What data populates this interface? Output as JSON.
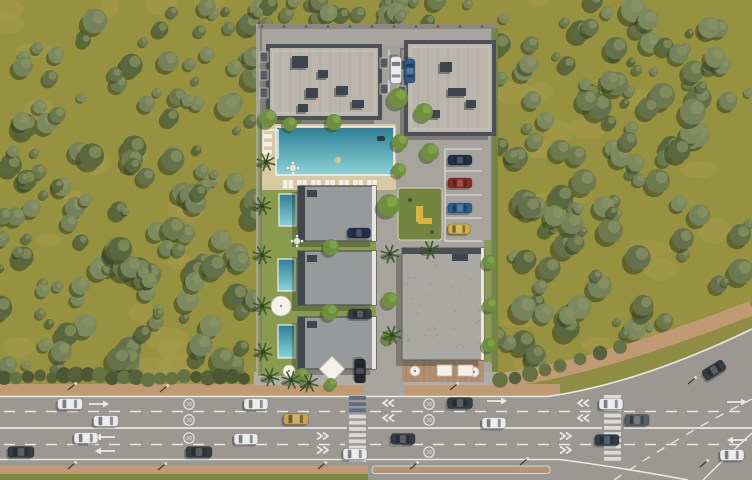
{
  "scene_label": "aerial-render-residential-complex",
  "road": {
    "speed_symbol": "30"
  },
  "palette": {
    "forest_ground": "#97923f",
    "forest_ground_light": "#a89c4e",
    "tree_shadow": "#35401f",
    "tree_highlight": "#8b9464",
    "tree_bodies": [
      "#6d7a4e",
      "#75825a",
      "#64714a",
      "#7c8a5e",
      "#59683e"
    ],
    "hedge": [
      "#55613a",
      "#647244",
      "#4c5833"
    ],
    "property_paver": "#a7a49d",
    "property_paver_light": "#b0ada6",
    "lawn": "#8a9a4e",
    "lawn_dark": "#73853f",
    "roof_light": "#bab6ac",
    "roof_trim": "#4d5157",
    "roof_box": "#3e4550",
    "villa_roof": "#97999b",
    "villa_roof_dark": "#40464e",
    "big_roof": "#a9a8a3",
    "deck_wood": "#b09070",
    "pool_deep": "#2c7f97",
    "pool_shallow": "#8ed2d6",
    "pool_rim": "#f0efe8",
    "pool_deck": "#d9c9a3",
    "road_gray": "#9b9793",
    "line_white": "#e9e9e6",
    "tan": "#c09a73",
    "grass": "#7a8a3e",
    "median_gravel": "#b29676",
    "crosswalk_blue": "#5a6a84",
    "wall": "#8a8a82",
    "play_yellow": "#d9b33c",
    "car_colors": {
      "white": "#e9eae9",
      "dark": "#363c43",
      "gray": "#585e64",
      "gold": "#c9a153",
      "red": "#8e2823",
      "blue": "#2b5e91",
      "navy": "#232f49",
      "yellow": "#d2af3e",
      "black": "#24272b"
    }
  },
  "scene": {
    "forest": {
      "left_rect": {
        "x": 0,
        "y": 0,
        "w": 258,
        "h": 384
      },
      "top_rect": {
        "x": 258,
        "y": 0,
        "w": 238,
        "h": 28
      },
      "right_poly": "M494,0 H752 V300 C700,316 640,346 560,366 C540,370 515,372 494,372 Z",
      "right_edge_samples": [
        [
          494,
          370
        ],
        [
          560,
          364
        ],
        [
          620,
          348
        ],
        [
          680,
          328
        ],
        [
          752,
          298
        ]
      ],
      "tree_counts": {
        "left": 155,
        "right": 130,
        "top": 26
      },
      "patch_counts": {
        "left": 26,
        "right": 20
      }
    },
    "roadside": {
      "tan_north": {
        "x": 0,
        "y": 384,
        "w": 560,
        "h": 12
      },
      "tan_curve": "M494,381 C560,374 640,351 752,308",
      "sidewalk_front": {
        "x": 254,
        "y": 372,
        "w": 246,
        "h": 13
      },
      "tan_south": {
        "x": 0,
        "y": 466,
        "w": 368,
        "h": 8
      },
      "grass_south": {
        "x": 0,
        "y": 474,
        "w": 368,
        "h": 6
      },
      "hedge_curve": [
        [
          500,
          380
        ],
        [
          515,
          378
        ],
        [
          530,
          374
        ],
        [
          545,
          370
        ],
        [
          560,
          366
        ],
        [
          580,
          359
        ],
        [
          600,
          353
        ],
        [
          620,
          347
        ]
      ]
    },
    "roadway": {
      "main_poly": "M0,397 H548 C620,386 690,358 752,328 V480 H0 Z",
      "north_curb": "M0,396.5 H548 C620,386 690,359 752,329",
      "south_curb": "M0,459.5 H560",
      "branch_west": "M560,459.5 C610,466 650,473 688,480",
      "branch_east": "M703,480 C722,461 737,447 752,433",
      "branch_dash": "M614,480 C662,448 704,423 752,399",
      "dashes": [
        {
          "y": 411.5,
          "segs": [
            [
              4,
              345
            ],
            [
              370,
              600
            ],
            [
              624,
              748
            ]
          ]
        },
        {
          "y": 444.5,
          "segs": [
            [
              4,
              345
            ],
            [
              370,
              600
            ],
            [
              624,
              748
            ]
          ]
        }
      ],
      "solids": [
        {
          "y": 428,
          "segs": [
            [
              0,
              347
            ],
            [
              368,
              602
            ],
            [
              624,
              752
            ]
          ],
          "w": 1.8
        }
      ],
      "median": {
        "x": 372,
        "y": 466,
        "w": 178,
        "h": 7.5
      },
      "entrance_apron": {
        "x": 363,
        "y": 372,
        "w": 42,
        "h": 25
      },
      "crosswalks": [
        {
          "x": 349,
          "w": 17,
          "y0": 396,
          "y1": 458,
          "blue_top": 3
        },
        {
          "x": 604,
          "w": 17,
          "y0": 395,
          "y1": 458,
          "blue_top": 0
        }
      ],
      "arrows": [
        {
          "x": 102,
          "y": 404,
          "dir": "left"
        },
        {
          "x": 740,
          "y": 402,
          "dir": "left"
        },
        {
          "x": 102,
          "y": 437,
          "dir": "right"
        },
        {
          "x": 102,
          "y": 451,
          "dir": "right"
        },
        {
          "x": 500,
          "y": 401,
          "dir": "left"
        },
        {
          "x": 734,
          "y": 440,
          "dir": "right"
        }
      ],
      "chevrons": [
        {
          "x": 383,
          "y": 403,
          "dir": "left"
        },
        {
          "x": 383,
          "y": 418,
          "dir": "left"
        },
        {
          "x": 328,
          "y": 436,
          "dir": "right"
        },
        {
          "x": 328,
          "y": 450,
          "dir": "right"
        },
        {
          "x": 578,
          "y": 403,
          "dir": "left"
        },
        {
          "x": 578,
          "y": 418,
          "dir": "left"
        },
        {
          "x": 571,
          "y": 436,
          "dir": "right"
        },
        {
          "x": 571,
          "y": 450,
          "dir": "right"
        }
      ],
      "speed_circles": [
        {
          "x": 189,
          "y": 404
        },
        {
          "x": 189,
          "y": 420
        },
        {
          "x": 189,
          "y": 438
        },
        {
          "x": 429,
          "y": 404
        },
        {
          "x": 429,
          "y": 420
        },
        {
          "x": 429,
          "y": 452
        }
      ],
      "lamps": [
        [
          68,
          390
        ],
        [
          160,
          392
        ],
        [
          300,
          391
        ],
        [
          450,
          390
        ],
        [
          68,
          469
        ],
        [
          158,
          470
        ],
        [
          318,
          469
        ],
        [
          410,
          469
        ],
        [
          520,
          465
        ],
        [
          688,
          384
        ],
        [
          700,
          467
        ]
      ]
    },
    "property": {
      "base": {
        "x": 256,
        "y": 24,
        "w": 240,
        "h": 348
      },
      "wall_top": {
        "x": 258,
        "y": 24,
        "w": 238,
        "h": 5
      },
      "right_green": {
        "x": 492,
        "y": 28,
        "w": 6,
        "h": 344
      },
      "lawns": [
        {
          "x": 258,
          "y": 120,
          "w": 44,
          "h": 256
        },
        {
          "x": 302,
          "y": 241,
          "w": 74,
          "h": 10
        },
        {
          "x": 302,
          "y": 305,
          "w": 74,
          "h": 12
        },
        {
          "x": 484,
          "y": 240,
          "w": 8,
          "h": 122
        }
      ],
      "terrace_deck": {
        "x": 402,
        "y": 360,
        "w": 82,
        "h": 22
      },
      "top_parking": {
        "x": 382,
        "y": 46,
        "w": 38,
        "h": 50,
        "stall_x": [
          389,
          403,
          417
        ]
      },
      "stall_lines": {
        "x0": 445,
        "x1": 482,
        "ys": [
          149,
          171,
          195,
          218,
          241
        ]
      },
      "playground": {
        "x": 398,
        "y": 188,
        "w": 44,
        "h": 52
      }
    },
    "buildings": [
      {
        "name": "apartment-block-a",
        "x": 268,
        "y": 46,
        "w": 112,
        "h": 72,
        "style": "apartment",
        "boxes": [
          [
            292,
            56,
            16,
            12
          ],
          [
            306,
            88,
            12,
            10
          ],
          [
            336,
            86,
            12,
            9
          ],
          [
            352,
            100,
            12,
            8
          ],
          [
            298,
            104,
            10,
            8
          ],
          [
            318,
            70,
            10,
            8
          ]
        ],
        "balconies": [
          [
            260,
            52,
            8,
            10
          ],
          [
            260,
            70,
            8,
            10
          ],
          [
            260,
            88,
            8,
            10
          ],
          [
            380,
            58,
            8,
            10
          ],
          [
            380,
            84,
            8,
            10
          ]
        ]
      },
      {
        "name": "apartment-block-b",
        "x": 406,
        "y": 42,
        "w": 88,
        "h": 92,
        "style": "apartment",
        "boxes": [
          [
            440,
            62,
            12,
            10
          ],
          [
            448,
            88,
            18,
            8
          ],
          [
            466,
            100,
            10,
            8
          ],
          [
            430,
            110,
            10,
            8
          ]
        ],
        "balconies": [
          [
            398,
            60,
            8,
            10
          ],
          [
            398,
            86,
            8,
            10
          ]
        ]
      },
      {
        "name": "villa-1",
        "x": 298,
        "y": 186,
        "w": 78,
        "h": 55,
        "style": "villa"
      },
      {
        "name": "villa-2",
        "x": 298,
        "y": 251,
        "w": 78,
        "h": 54,
        "style": "villa"
      },
      {
        "name": "villa-3",
        "x": 298,
        "y": 317,
        "w": 78,
        "h": 52,
        "style": "villa"
      },
      {
        "name": "commercial-block",
        "x": 402,
        "y": 248,
        "w": 82,
        "h": 112,
        "style": "big"
      }
    ],
    "pools": {
      "deck": {
        "x": 262,
        "y": 124,
        "w": 134,
        "h": 66
      },
      "main": {
        "x": 276,
        "y": 127,
        "w": 118,
        "h": 48
      },
      "villa_pools": [
        [
          279,
          194,
          17,
          32
        ],
        [
          278,
          259,
          17,
          32
        ],
        [
          278,
          325,
          17,
          33
        ]
      ],
      "lounger_row": {
        "x0": 283,
        "step": 14,
        "count": 7,
        "y": 180
      },
      "left_loungers": [
        [
          263,
          134
        ],
        [
          263,
          142
        ],
        [
          263,
          150
        ]
      ],
      "floats": {
        "yellow": [
          338,
          160
        ],
        "dark": [
          377,
          136
        ]
      }
    },
    "furniture": {
      "umbrellas": [
        [
          281,
          306,
          10
        ],
        [
          474,
          372,
          5
        ],
        [
          415,
          371,
          5
        ],
        [
          289,
          371,
          6
        ]
      ],
      "canopy_diamond": {
        "x": 332,
        "y": 369,
        "s": 18
      },
      "canopy_squares": [
        [
          437,
          365,
          15,
          11
        ],
        [
          458,
          365,
          15,
          11
        ]
      ],
      "dining_sets": [
        [
          297,
          241
        ],
        [
          293,
          168
        ]
      ],
      "pergola": {
        "x": 263,
        "y": 130,
        "w": 15,
        "h": 28
      }
    },
    "vegetation": {
      "palms": [
        [
          262,
          206
        ],
        [
          262,
          255
        ],
        [
          262,
          306
        ],
        [
          263,
          352
        ],
        [
          270,
          377
        ],
        [
          291,
          380
        ],
        [
          309,
          383
        ],
        [
          266,
          162
        ],
        [
          390,
          254
        ],
        [
          430,
          250
        ],
        [
          392,
          335
        ]
      ],
      "trees": [
        [
          268,
          118,
          9
        ],
        [
          290,
          124,
          7
        ],
        [
          334,
          122,
          8
        ],
        [
          398,
          98,
          10
        ],
        [
          424,
          112,
          9
        ],
        [
          400,
          142,
          8
        ],
        [
          430,
          152,
          9
        ],
        [
          399,
          170,
          7
        ],
        [
          331,
          247,
          8
        ],
        [
          330,
          312,
          8
        ],
        [
          389,
          205,
          11
        ],
        [
          390,
          300,
          8
        ],
        [
          389,
          337,
          7
        ],
        [
          489,
          262,
          7
        ],
        [
          490,
          305,
          7
        ],
        [
          489,
          345,
          7
        ],
        [
          302,
          375,
          7
        ],
        [
          331,
          384,
          6
        ]
      ]
    },
    "vehicles": [
      {
        "x": 70,
        "y": 404,
        "a": 0,
        "l": 25,
        "w": 11,
        "c": "white"
      },
      {
        "x": 256,
        "y": 404,
        "a": 0,
        "l": 24,
        "w": 11,
        "c": "white"
      },
      {
        "x": 460,
        "y": 403,
        "a": 0,
        "l": 25,
        "w": 11,
        "c": "dark"
      },
      {
        "x": 611,
        "y": 404,
        "a": 0,
        "l": 24,
        "w": 11,
        "c": "white"
      },
      {
        "x": 106,
        "y": 421,
        "a": 0,
        "l": 25,
        "w": 11,
        "c": "white"
      },
      {
        "x": 296,
        "y": 419,
        "a": 0,
        "l": 25,
        "w": 11,
        "c": "gold"
      },
      {
        "x": 494,
        "y": 423,
        "a": 0,
        "l": 24,
        "w": 11,
        "c": "white"
      },
      {
        "x": 637,
        "y": 420,
        "a": 0,
        "l": 24,
        "w": 11,
        "c": "gray"
      },
      {
        "x": 86,
        "y": 438,
        "a": 0,
        "l": 24,
        "w": 11,
        "c": "white"
      },
      {
        "x": 246,
        "y": 439,
        "a": 0,
        "l": 24,
        "w": 11,
        "c": "white"
      },
      {
        "x": 403,
        "y": 439,
        "a": 0,
        "l": 24,
        "w": 11,
        "c": "dark"
      },
      {
        "x": 607,
        "y": 440,
        "a": 0,
        "l": 24,
        "w": 11,
        "c": "dark"
      },
      {
        "x": 21,
        "y": 452,
        "a": 0,
        "l": 26,
        "w": 11,
        "c": "dark"
      },
      {
        "x": 199,
        "y": 452,
        "a": 0,
        "l": 26,
        "w": 11,
        "c": "dark"
      },
      {
        "x": 355,
        "y": 454,
        "a": 0,
        "l": 24,
        "w": 11,
        "c": "white"
      },
      {
        "x": 732,
        "y": 455,
        "a": 0,
        "l": 24,
        "w": 11,
        "c": "white"
      },
      {
        "x": 714,
        "y": 370,
        "a": -32,
        "l": 24,
        "w": 11,
        "c": "dark"
      },
      {
        "x": 396,
        "y": 70,
        "a": 90,
        "l": 27,
        "w": 11,
        "c": "white"
      },
      {
        "x": 410,
        "y": 71,
        "a": 90,
        "l": 24,
        "w": 10,
        "c": "blue"
      },
      {
        "x": 460,
        "y": 160,
        "a": 0,
        "l": 24,
        "w": 10,
        "c": "navy"
      },
      {
        "x": 460,
        "y": 183,
        "a": 0,
        "l": 24,
        "w": 10,
        "c": "red"
      },
      {
        "x": 460,
        "y": 208,
        "a": 0,
        "l": 24,
        "w": 10,
        "c": "blue"
      },
      {
        "x": 459,
        "y": 229,
        "a": 0,
        "l": 22,
        "w": 10,
        "c": "yellow"
      },
      {
        "x": 359,
        "y": 233,
        "a": 0,
        "l": 23,
        "w": 10,
        "c": "navy"
      },
      {
        "x": 360,
        "y": 314,
        "a": 0,
        "l": 23,
        "w": 10,
        "c": "dark"
      },
      {
        "x": 360,
        "y": 371,
        "a": 90,
        "l": 24,
        "w": 11,
        "c": "black"
      }
    ]
  }
}
